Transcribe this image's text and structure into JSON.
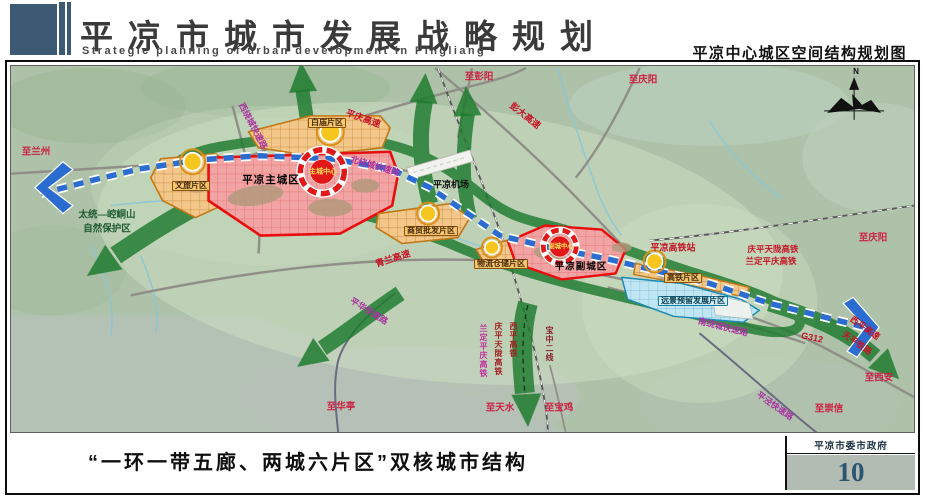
{
  "header": {
    "title": "平凉市城市发展战略规划",
    "subtitle": "Strategic planning of urban development in Pingliang",
    "map_title": "平凉中心城区空间结构规划图"
  },
  "footer": {
    "caption": "“一环一带五廊、两城六片区”双核城市结构",
    "agency": "平凉市委市政府",
    "page_number": "10"
  },
  "map": {
    "compass_n": "N",
    "districts": {
      "wenlu": "文旅片区",
      "baimiao": "白庙片区",
      "main_city": "平凉主城区",
      "main_center": "主城中心",
      "shangmao": "商贸批发片区",
      "wuliu": "物流仓储片区",
      "sub_city": "平凉副城区",
      "sub_center": "副城中心",
      "gaotie": "高铁片区",
      "yuanjing": "远景预留发展片区"
    },
    "roads": {
      "pengda": "彭大高速",
      "pingqing": "平庆高速",
      "qinglan": "青兰高速",
      "g312": "G312",
      "xiping_expwy": "西平高速",
      "tianping_rail": "天平铁路",
      "west_ring": "西绕城快速路",
      "north_ring": "北绕城快速路",
      "south_ring": "南绕城快速路",
      "pinghua": "平华快速路",
      "pingjing": "平泾快速路"
    },
    "railways": {
      "qingping_tianlong": "庆平天陇高铁",
      "landing_pingqing": "兰定平庆高铁",
      "xiping": "西平高铁",
      "baozhong": "宝中二线"
    },
    "stations": {
      "hsr_station": "平凉高铁站",
      "airport": "平凉机场"
    },
    "destinations": {
      "lanzhou": "至兰州",
      "pengyang": "至彭阳",
      "qingyang_top": "至庆阳",
      "qingyang_right": "至庆阳",
      "xian": "至西安",
      "chongxin": "至崇信",
      "huating": "至华亭",
      "tianshui": "至天水",
      "baoji": "至宝鸡"
    },
    "nature_reserve": {
      "line1": "太统—崆峒山",
      "line2": "自然保护区"
    },
    "colors": {
      "belt_blue": "#2a6cd0",
      "corridor_green": "#1e7b2f",
      "district_orange": "#f3c689",
      "district_red": "#f2a3a3",
      "district_cyan": "#bfe6f2",
      "accent_slate": "#3c5a74"
    }
  }
}
